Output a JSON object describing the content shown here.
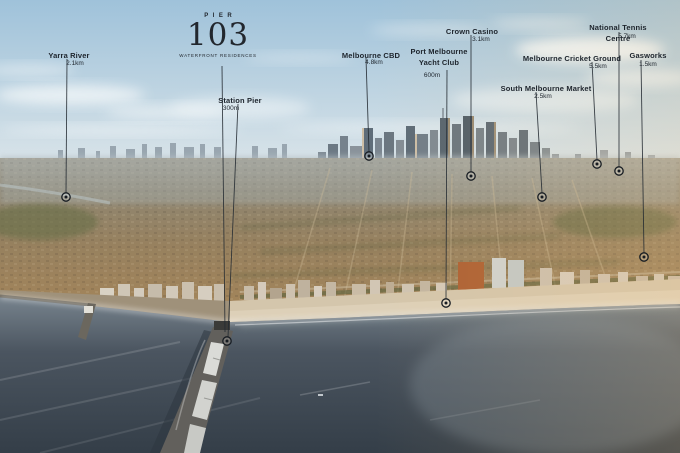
{
  "brand": {
    "word": "PIER",
    "number": "103",
    "subtitle": "WATERFRONT RESIDENCES"
  },
  "colors": {
    "label_text": "#1d242c",
    "leader_line": "#232a31",
    "marker": "#171c22"
  },
  "logo_leader_line": [
    222,
    66,
    225,
    332
  ],
  "landmarks": [
    {
      "id": "yarra-river",
      "name": "Yarra River",
      "distance": "2.1km",
      "label_x": 69,
      "label_y": 51,
      "dist_x": 75,
      "dist_y": 60,
      "line": [
        67,
        59,
        66,
        193
      ],
      "marker": [
        66,
        197
      ]
    },
    {
      "id": "station-pier",
      "name": "Station Pier",
      "distance": "300m",
      "label_x": 240,
      "label_y": 96,
      "dist_x": 231,
      "dist_y": 105,
      "line": [
        238,
        104,
        228,
        337
      ],
      "marker": [
        227,
        341
      ]
    },
    {
      "id": "melbourne-cbd",
      "name": "Melbourne CBD",
      "distance": "4.8km",
      "label_x": 371,
      "label_y": 51,
      "dist_x": 374,
      "dist_y": 59,
      "line": [
        366,
        58,
        369,
        152
      ],
      "marker": [
        369,
        156
      ]
    },
    {
      "id": "port-melbourne-yacht-club",
      "name": "Port Melbourne\nYacht Club",
      "distance": "600m",
      "label_x": 439,
      "label_y": 47,
      "dist_x": 432,
      "dist_y": 72,
      "line": [
        447,
        70,
        446,
        299
      ],
      "marker": [
        446,
        303
      ]
    },
    {
      "id": "crown-casino",
      "name": "Crown Casino",
      "distance": "3.1km",
      "label_x": 472,
      "label_y": 27,
      "dist_x": 481,
      "dist_y": 36,
      "line": [
        471,
        35,
        471,
        172
      ],
      "marker": [
        471,
        176
      ]
    },
    {
      "id": "south-melbourne-market",
      "name": "South Melbourne Market",
      "distance": "2.5km",
      "label_x": 546,
      "label_y": 84,
      "dist_x": 543,
      "dist_y": 93,
      "line": [
        536,
        92,
        542,
        193
      ],
      "marker": [
        542,
        197
      ]
    },
    {
      "id": "melbourne-cricket-ground",
      "name": "Melbourne Cricket Ground",
      "distance": "5.5km",
      "label_x": 572,
      "label_y": 54,
      "dist_x": 598,
      "dist_y": 63,
      "line": [
        592,
        62,
        597,
        160
      ],
      "marker": [
        597,
        164
      ]
    },
    {
      "id": "national-tennis-centre",
      "name": "National Tennis Centre",
      "distance": "5.7km",
      "label_x": 618,
      "label_y": 23,
      "dist_x": 627,
      "dist_y": 33,
      "line": [
        619,
        32,
        619,
        167
      ],
      "marker": [
        619,
        171
      ]
    },
    {
      "id": "gasworks",
      "name": "Gasworks",
      "distance": "1.5km",
      "label_x": 648,
      "label_y": 51,
      "dist_x": 648,
      "dist_y": 61,
      "line": [
        641,
        60,
        644,
        253
      ],
      "marker": [
        644,
        257
      ]
    }
  ]
}
